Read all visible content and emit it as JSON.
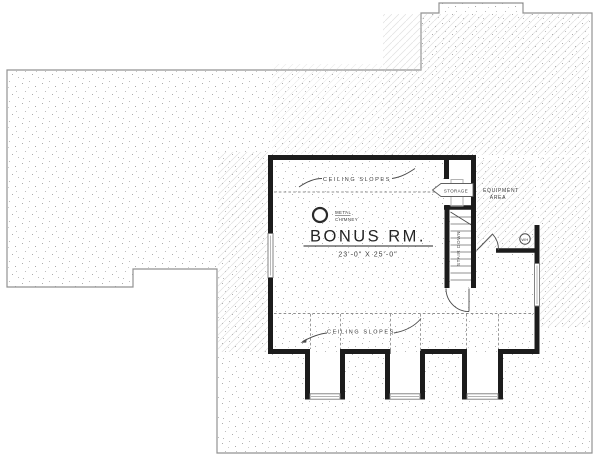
{
  "plan": {
    "room": {
      "name": "BONUS RM.",
      "dimensions": "23'-0\" X 25'-0\""
    },
    "annotations": {
      "ceiling_slopes_top": "CEILING SLOPES",
      "ceiling_slopes_bottom": "CEILING SLOPES",
      "chimney_line1": "METAL",
      "chimney_line2": "CHIMNEY",
      "storage": "STORAGE",
      "equipment_line1": "EQUIPMENT",
      "equipment_line2": "AREA",
      "stair": "STAIR DOWN",
      "water_heater": "WH"
    },
    "colors": {
      "wall": "#1c1c1c",
      "outline": "#929292",
      "text": "#3a3a3a"
    }
  }
}
